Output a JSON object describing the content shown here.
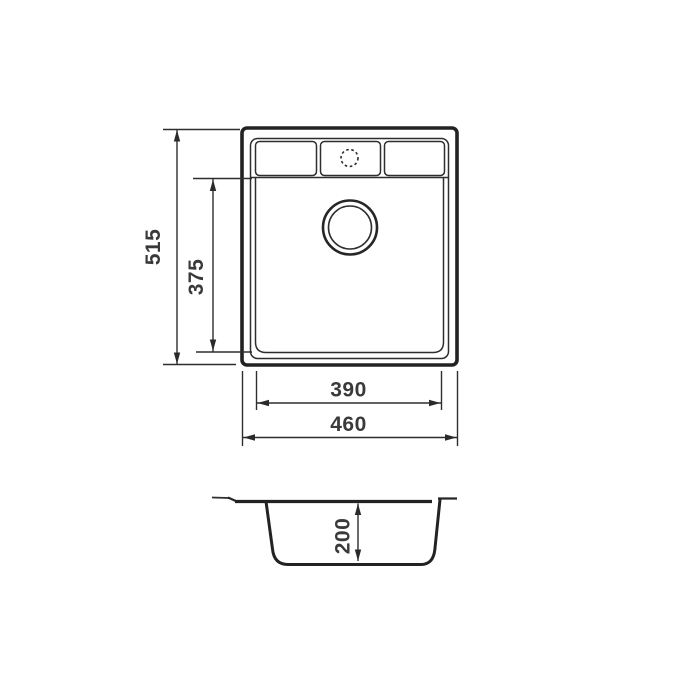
{
  "drawing": {
    "description": "Technical dimension drawing of a single-bowl kitchen sink, top view and cross-section view",
    "background_color": "#ffffff",
    "line_color": "#2a2a2a",
    "text_color": "#3a3a3a",
    "views": {
      "top_view": "sink plan view with tap ledge, three ledge panels, dotted tap hole and round drain",
      "side_view": "sink bowl cross-section profile"
    },
    "dimensions": {
      "overall_length": "515",
      "bowl_length": "375",
      "bowl_width": "390",
      "overall_width": "460",
      "bowl_depth": "200"
    }
  }
}
